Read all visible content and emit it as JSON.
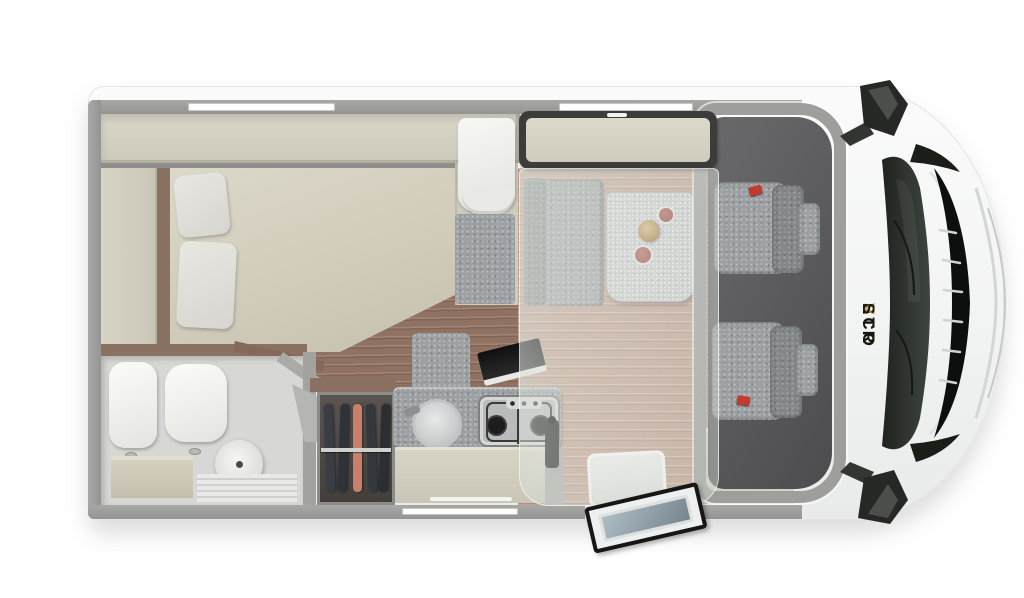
{
  "scene": {
    "type": "motorhome-floorplan-3d-render",
    "view": "top-down",
    "vehicle_orientation": "cab-and-front-on-right"
  },
  "brand": {
    "pre": "ETR",
    "v": "V",
    "post": "SCO",
    "full": "ETRVSCO"
  },
  "palette": {
    "background": "#ffffff",
    "body_white": "#f7f8f8",
    "wall_gray": "#9e9e9c",
    "cabinet_beige": "#d5d1c3",
    "mattress_beige": "#d3cfc0",
    "upholstery_gray": "#9da0a2",
    "table_gray": "#cbcdcd",
    "floor_dark_wood": "#8f7261",
    "floor_light_wood": "#c2a190",
    "cab_floor_dark": "#555557",
    "windshield_glass": "#2b302c",
    "seatbelt_red": "#c23b2e",
    "garment_salmon": "#c97f6c",
    "brand_gold": "#b8912e"
  },
  "rooms": [
    "rear-bed",
    "bathroom",
    "wardrobe",
    "kitchen",
    "dinette",
    "drop-down-bed",
    "cab"
  ]
}
